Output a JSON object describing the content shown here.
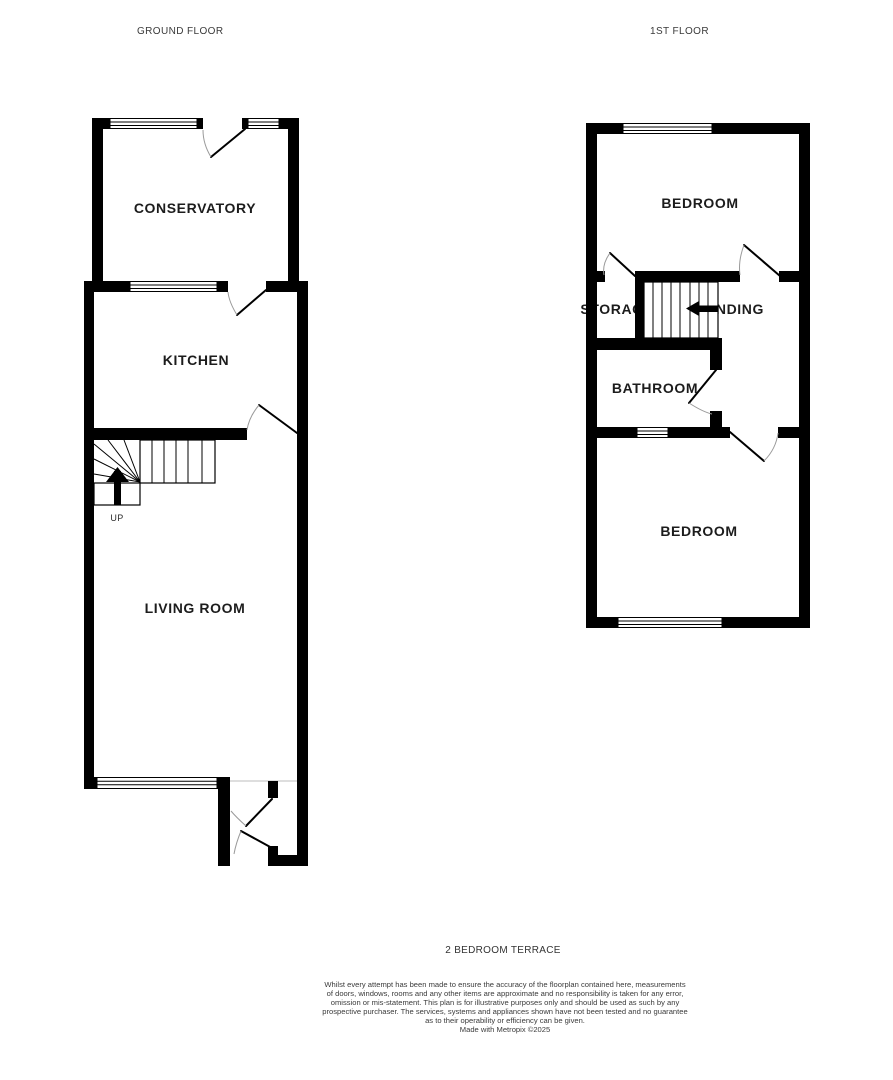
{
  "header": {
    "ground_floor_label": "GROUND FLOOR",
    "first_floor_label": "1ST FLOOR"
  },
  "ground_floor": {
    "conservatory_label": "CONSERVATORY",
    "kitchen_label": "KITCHEN",
    "living_room_label": "LIVING ROOM",
    "stairs_up_label": "UP"
  },
  "first_floor": {
    "bedroom_front_label": "BEDROOM",
    "storage_label": "STORAGE",
    "landing_label": "LANDING",
    "bathroom_label": "BATHROOM",
    "bedroom_back_label": "BEDROOM"
  },
  "footer": {
    "property_title": "2 BEDROOM TERRACE",
    "disclaimer_lines": [
      "Whilst every attempt has been made to ensure the accuracy of the floorplan contained here, measurements",
      "of doors, windows, rooms and any other items are approximate and no responsibility is taken for any error,",
      "omission or mis-statement. This plan is for illustrative purposes only and should be used as such by any",
      "prospective purchaser. The services, systems and appliances shown have not been tested and no guarantee",
      "as to their operability or efficiency can be given."
    ],
    "credit": "Made with Metropix ©2025"
  },
  "colors": {
    "wall": "#000000",
    "door_arc": "#9a9a9a",
    "label_text": "#1c1c1c",
    "footer_text": "#3a3a3a"
  }
}
